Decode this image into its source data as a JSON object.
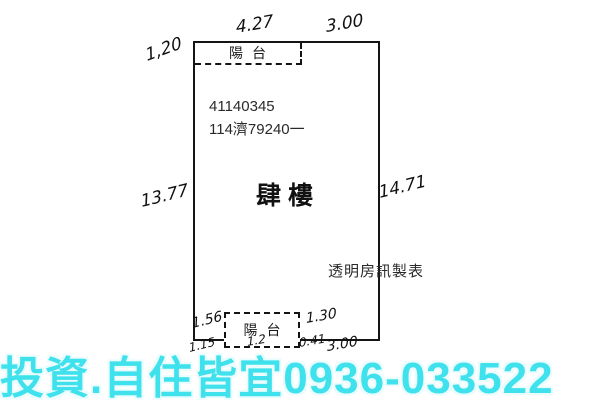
{
  "plan": {
    "registration_line1": "41140345",
    "registration_line2": "114濟79240一",
    "floor_label": "肆樓",
    "maker_label": "透明房訊製表",
    "balcony_top_label": "陽台",
    "balcony_bottom_label": "陽台",
    "dimensions": {
      "top_left_offset": "1,20",
      "top_balcony_width": "4.27",
      "top_right_width": "3.00",
      "left_height": "13.77",
      "right_height": "14.71",
      "bottom_left_offset": "1.56",
      "bottom_left_lower": "1.15",
      "bottom_mid_fragment": "1.2",
      "bottom_inner_right": "1.30",
      "bottom_small": "0.41",
      "bottom_right_width": "3.00"
    },
    "line_color": "#141414"
  },
  "watermark": {
    "text": "投資.自住皆宜0936-033522",
    "color": "#3FE1EC"
  }
}
